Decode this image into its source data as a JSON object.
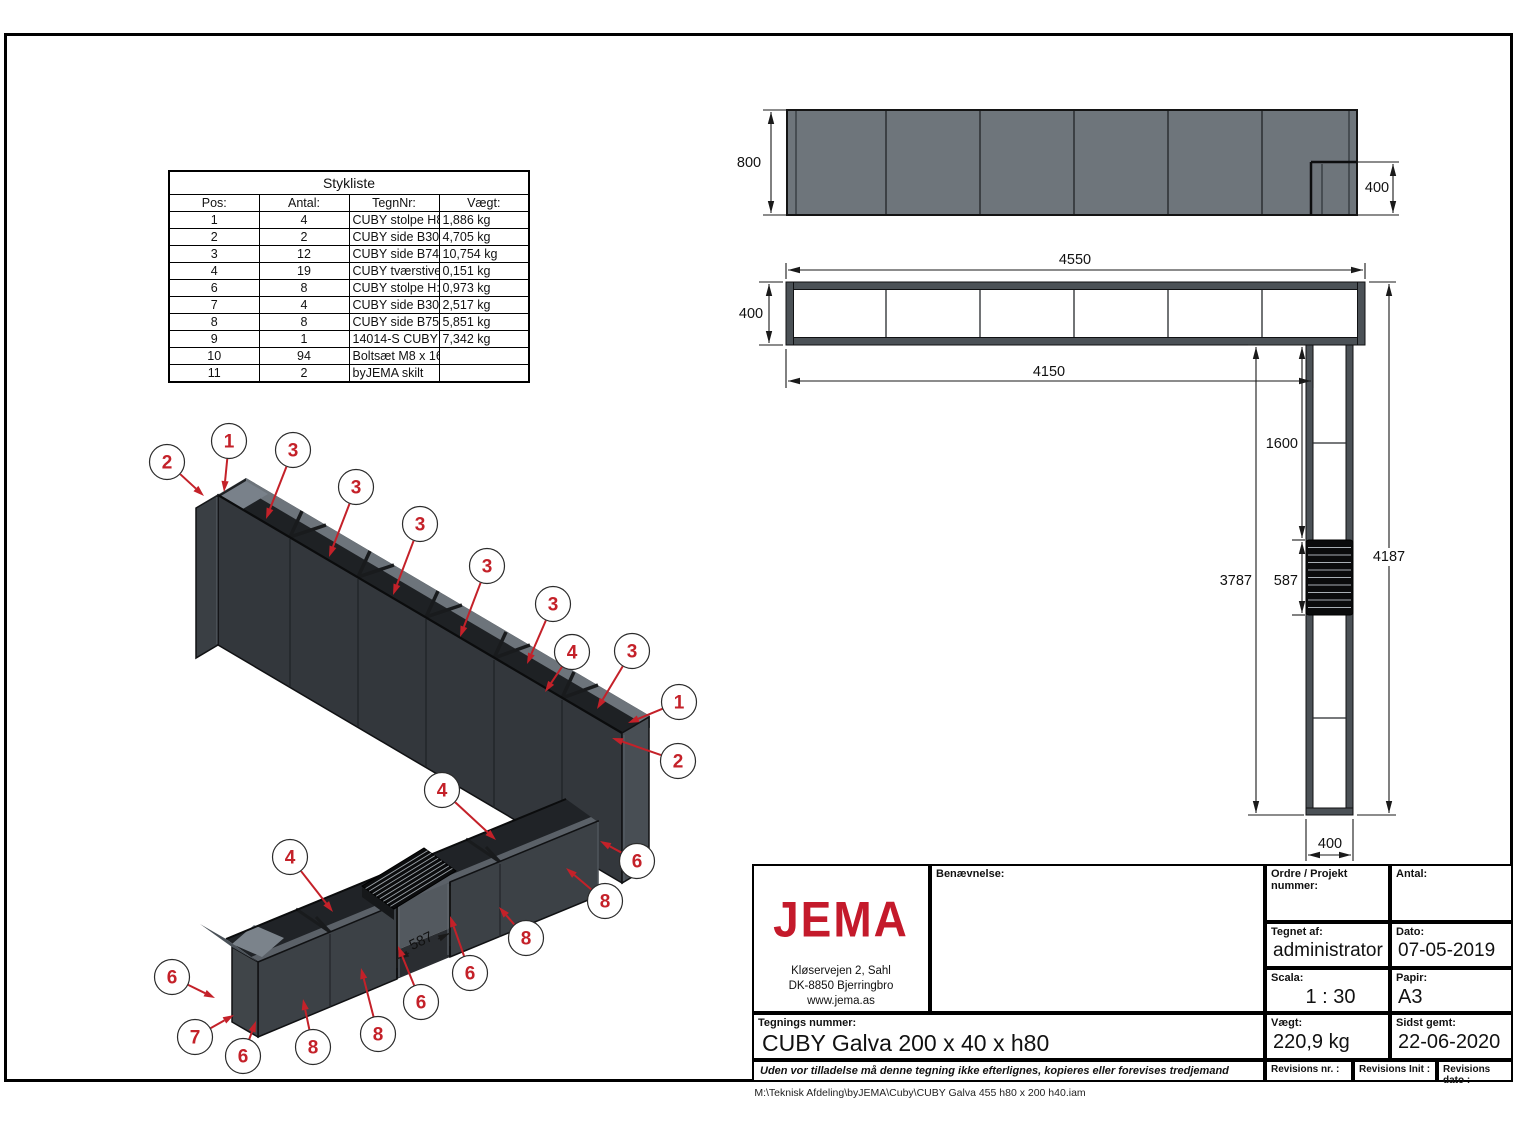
{
  "footer_path": "M:\\Teknisk Afdeling\\byJEMA\\Cuby\\CUBY Galva 455 h80 x 200 h40.iam",
  "parts_table": {
    "title": "Stykliste",
    "headers": [
      "Pos:",
      "Antal:",
      "TegnNr:",
      "Vægt:"
    ],
    "rows": [
      [
        "1",
        "4",
        "CUBY stolpe H800 galva",
        "1,886 kg"
      ],
      [
        "2",
        "2",
        "CUBY side B300 H800 Galva",
        "4,705 kg"
      ],
      [
        "3",
        "12",
        "CUBY side B741,667 H800 Galva",
        "10,754 kg"
      ],
      [
        "4",
        "19",
        "CUBY tværstiver 400 Galva",
        "0,151 kg"
      ],
      [
        "6",
        "8",
        "CUBY stolpe H:400 Galva",
        "0,973 kg"
      ],
      [
        "7",
        "4",
        "CUBY side B300 H400",
        "2,517 kg"
      ],
      [
        "8",
        "8",
        "CUBY side B750 H400 - Galva",
        "5,851 kg"
      ],
      [
        "9",
        "1",
        "14014-S CUBY bænk sort lille",
        "7,342 kg"
      ],
      [
        "10",
        "94",
        "Boltsæt M8 x 16",
        ""
      ],
      [
        "11",
        "2",
        "byJEMA skilt",
        ""
      ]
    ]
  },
  "title_block": {
    "logo_text": "JEMA",
    "address": [
      "Kløservejen 2, Sahl",
      "DK-8850 Bjerringbro",
      "www.jema.as"
    ],
    "benaevnelse_label": "Benævnelse:",
    "ordre_label": "Ordre / Projekt nummer:",
    "antal_label": "Antal:",
    "tegnet_label": "Tegnet af:",
    "tegnet_value": "administrator",
    "dato_label": "Dato:",
    "dato_value": "07-05-2019",
    "scala_label": "Scala:",
    "scala_value": "1 : 30",
    "papir_label": "Papir:",
    "papir_value": "A3",
    "tegnings_label": "Tegnings nummer:",
    "tegnings_value": "CUBY Galva 200 x 40 x h80",
    "vaegt_label": "Vægt:",
    "vaegt_value": "220,9 kg",
    "sidst_label": "Sidst gemt:",
    "sidst_value": "22-06-2020",
    "disclaimer": "Uden vor tilladelse må denne tegning ikke efterlignes, kopieres eller forevises tredjemand",
    "rev_nr_label": "Revisions nr. :",
    "rev_init_label": "Revisions Init :",
    "rev_dato_label": "Revisions dato :"
  },
  "drawing": {
    "colors": {
      "red": "#c42129",
      "body_dark": "#33373c",
      "elev_gray": "#6e757b"
    },
    "dim_labels": [
      {
        "t": "800",
        "x": 749,
        "y": 167,
        "anchor": "middle"
      },
      {
        "t": "400",
        "x": 1377,
        "y": 192,
        "anchor": "middle"
      },
      {
        "t": "4550",
        "x": 1075,
        "y": 264,
        "anchor": "middle"
      },
      {
        "t": "400",
        "x": 751,
        "y": 318,
        "anchor": "middle"
      },
      {
        "t": "4150",
        "x": 1049,
        "y": 376,
        "anchor": "middle"
      },
      {
        "t": "1600",
        "x": 1298,
        "y": 448,
        "anchor": "end"
      },
      {
        "t": "3787",
        "x": 1252,
        "y": 585,
        "anchor": "end"
      },
      {
        "t": "587",
        "x": 1298,
        "y": 585,
        "anchor": "end"
      },
      {
        "t": "4187",
        "x": 1389,
        "y": 561,
        "anchor": "middle",
        "bg": true
      },
      {
        "t": "400",
        "x": 1330,
        "y": 848,
        "anchor": "middle"
      },
      {
        "t": "587",
        "x": 423,
        "y": 945,
        "anchor": "middle",
        "rot": -26
      }
    ],
    "balloons": [
      {
        "n": "2",
        "x": 167,
        "y": 462,
        "tx": 204,
        "ty": 496
      },
      {
        "n": "1",
        "x": 229,
        "y": 441,
        "tx": 224,
        "ty": 492
      },
      {
        "n": "3",
        "x": 293,
        "y": 450,
        "tx": 266,
        "ty": 519
      },
      {
        "n": "3",
        "x": 356,
        "y": 487,
        "tx": 329,
        "ty": 557
      },
      {
        "n": "3",
        "x": 420,
        "y": 524,
        "tx": 393,
        "ty": 595
      },
      {
        "n": "3",
        "x": 487,
        "y": 566,
        "tx": 460,
        "ty": 637
      },
      {
        "n": "3",
        "x": 553,
        "y": 604,
        "tx": 527,
        "ty": 664
      },
      {
        "n": "4",
        "x": 572,
        "y": 652,
        "tx": 545,
        "ty": 692
      },
      {
        "n": "3",
        "x": 632,
        "y": 651,
        "tx": 597,
        "ty": 709
      },
      {
        "n": "1",
        "x": 679,
        "y": 702,
        "tx": 628,
        "ty": 723
      },
      {
        "n": "2",
        "x": 678,
        "y": 761,
        "tx": 612,
        "ty": 738
      },
      {
        "n": "4",
        "x": 442,
        "y": 790,
        "tx": 496,
        "ty": 840
      },
      {
        "n": "4",
        "x": 290,
        "y": 857,
        "tx": 333,
        "ty": 912
      },
      {
        "n": "6",
        "x": 637,
        "y": 861,
        "tx": 600,
        "ty": 841
      },
      {
        "n": "8",
        "x": 605,
        "y": 901,
        "tx": 566,
        "ty": 868
      },
      {
        "n": "8",
        "x": 526,
        "y": 938,
        "tx": 499,
        "ty": 907
      },
      {
        "n": "6",
        "x": 470,
        "y": 973,
        "tx": 450,
        "ty": 916
      },
      {
        "n": "6",
        "x": 421,
        "y": 1002,
        "tx": 398,
        "ty": 946
      },
      {
        "n": "8",
        "x": 378,
        "y": 1034,
        "tx": 361,
        "ty": 968
      },
      {
        "n": "8",
        "x": 313,
        "y": 1047,
        "tx": 303,
        "ty": 999
      },
      {
        "n": "6",
        "x": 243,
        "y": 1056,
        "tx": 256,
        "ty": 1021
      },
      {
        "n": "7",
        "x": 195,
        "y": 1037,
        "tx": 234,
        "ty": 1015
      },
      {
        "n": "6",
        "x": 172,
        "y": 977,
        "tx": 215,
        "ty": 998
      }
    ]
  }
}
